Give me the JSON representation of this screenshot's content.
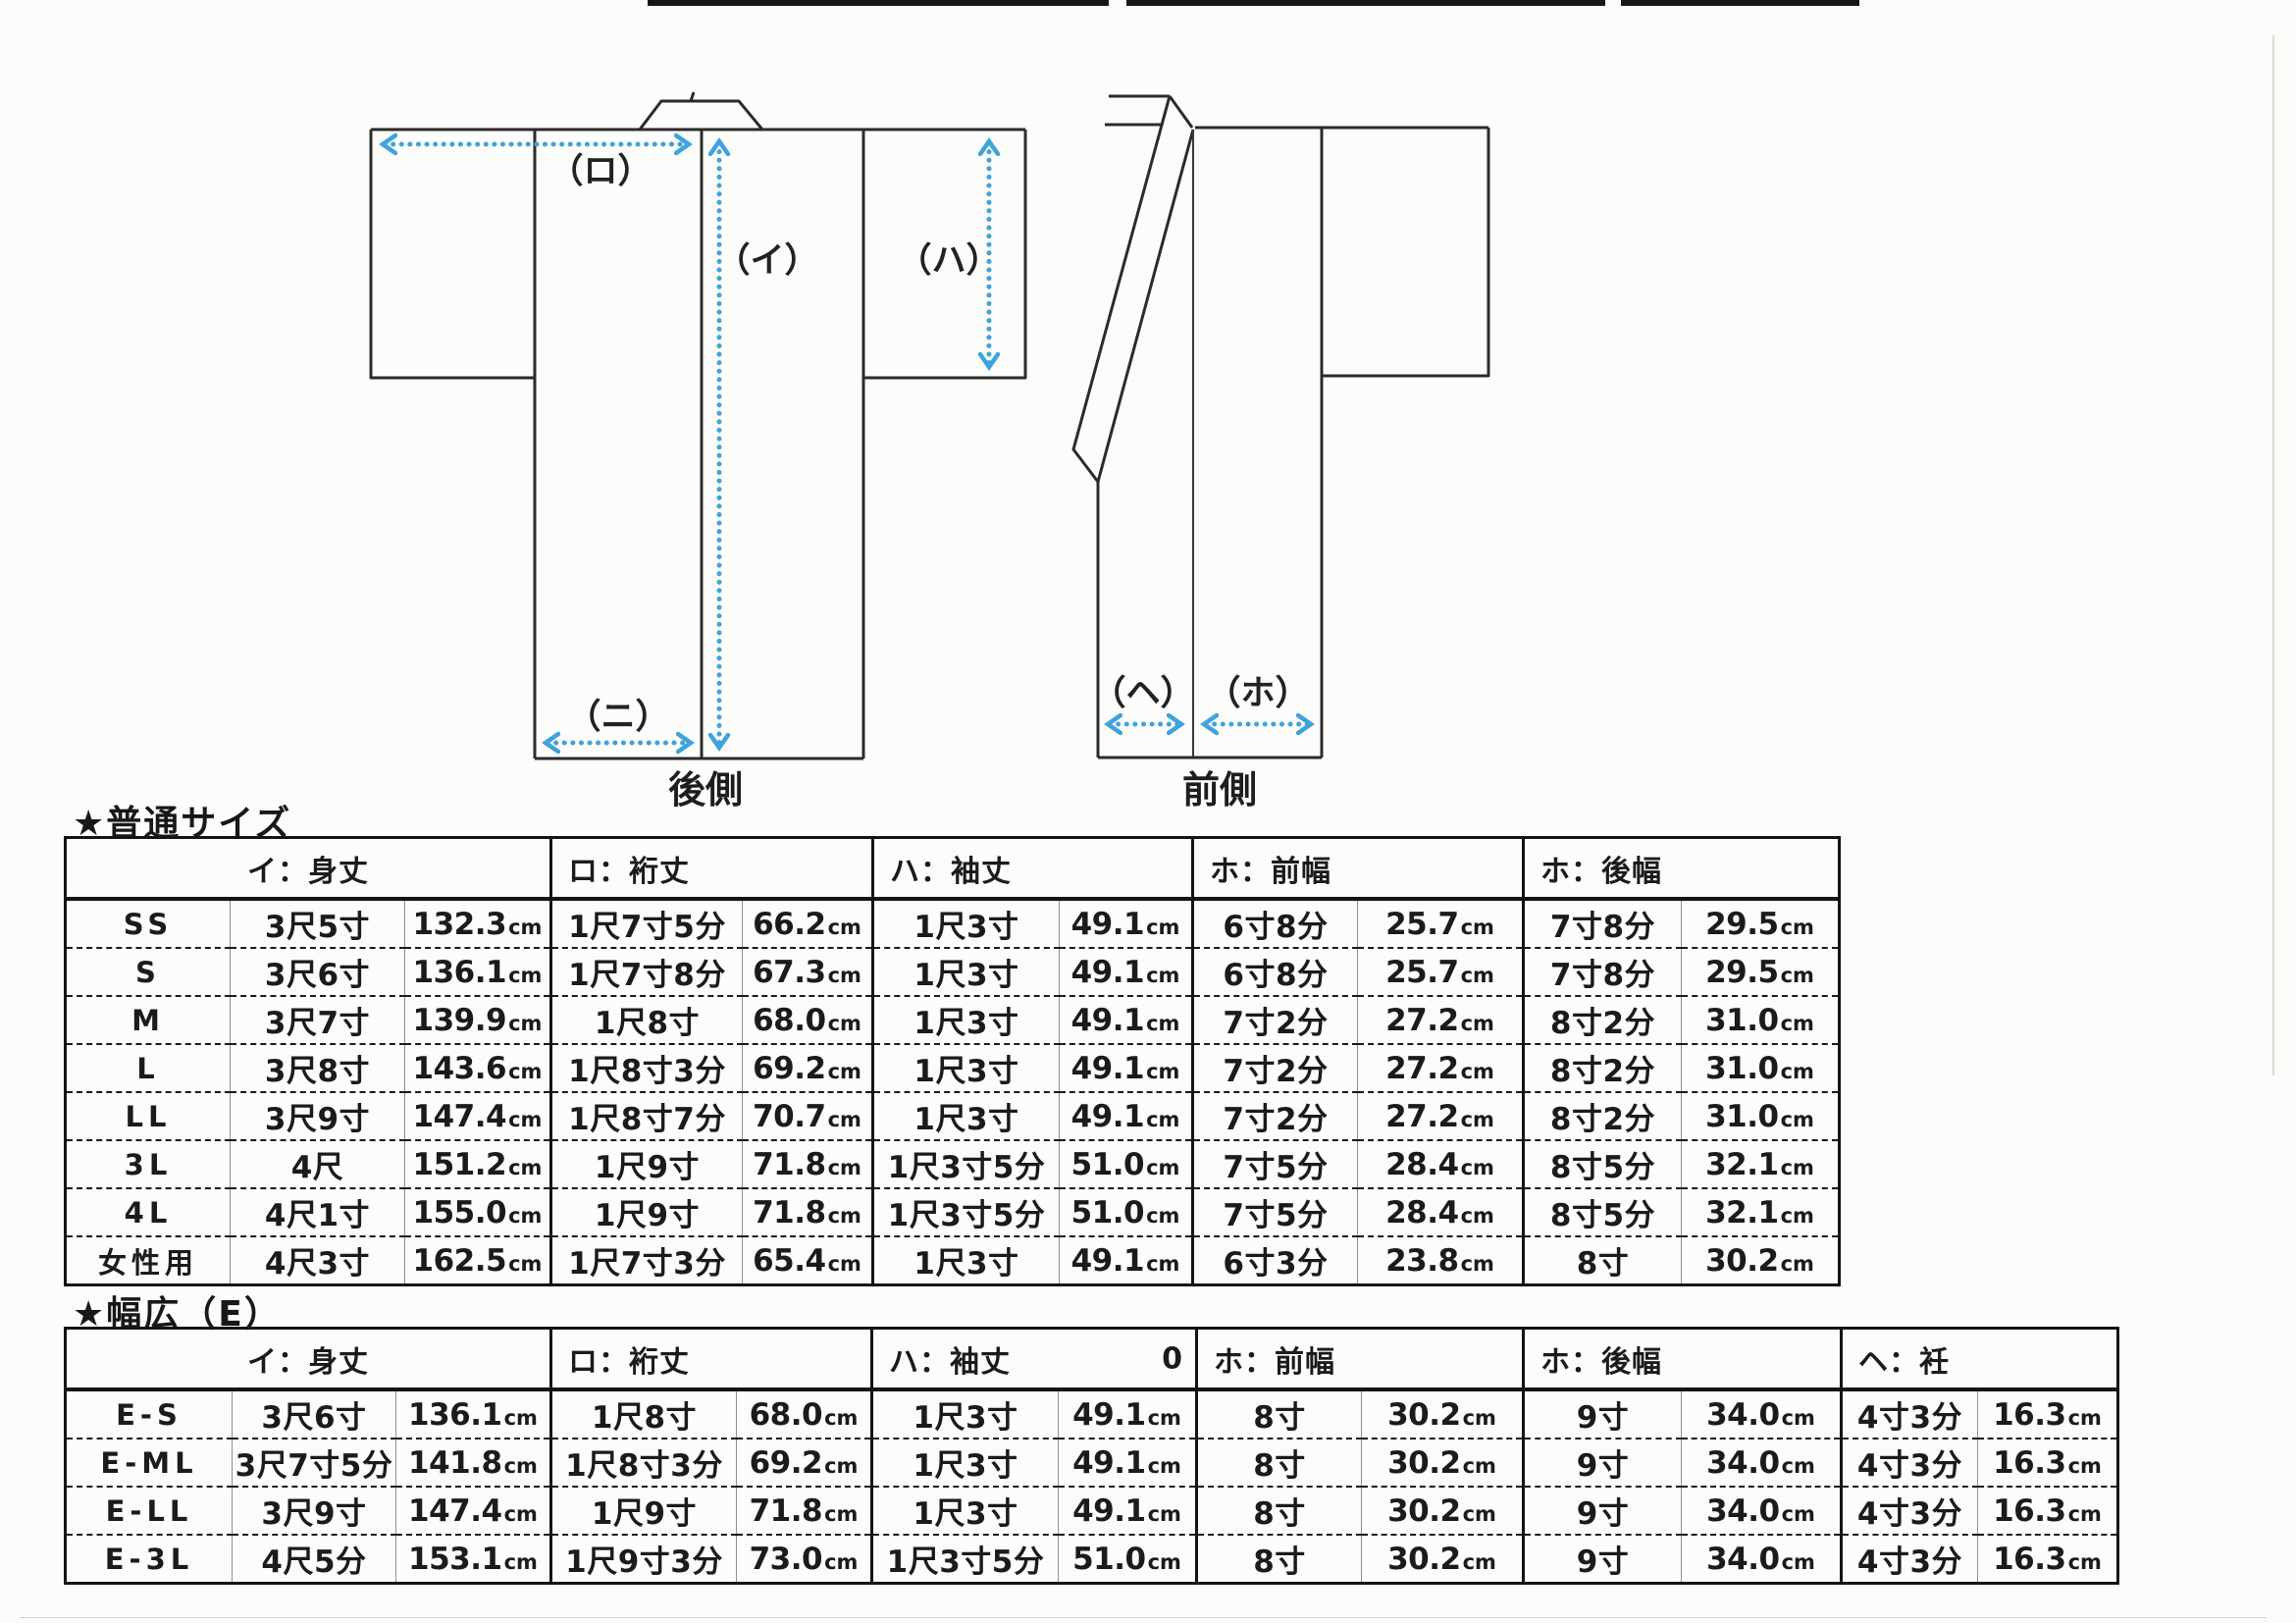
{
  "diagram": {
    "arrow_color": "#3fa3dc",
    "labels": {
      "ro": "（ロ）",
      "i": "（イ）",
      "ha": "（ハ）",
      "ni": "（ニ）",
      "he": "（ヘ）",
      "ho": "（ホ）"
    },
    "back_caption": "後側",
    "front_caption": "前側"
  },
  "sections": {
    "normal": {
      "title": "★普通サイズ",
      "unit": "cm",
      "headers": [
        "イ：身丈",
        "ロ：裄丈",
        "ハ：袖丈",
        "ホ：前幅",
        "ホ：後幅"
      ],
      "fields": [
        "mitake",
        "yuki",
        "sode",
        "maehaba",
        "ushirohaba"
      ],
      "rows": [
        {
          "size": "SS",
          "mitake": "3尺5寸",
          "mitake_cm": "132.3",
          "yuki": "1尺7寸5分",
          "yuki_cm": "66.2",
          "sode": "1尺3寸",
          "sode_cm": "49.1",
          "maehaba": "6寸8分",
          "maehaba_cm": "25.7",
          "ushirohaba": "7寸8分",
          "ushirohaba_cm": "29.5"
        },
        {
          "size": "S",
          "mitake": "3尺6寸",
          "mitake_cm": "136.1",
          "yuki": "1尺7寸8分",
          "yuki_cm": "67.3",
          "sode": "1尺3寸",
          "sode_cm": "49.1",
          "maehaba": "6寸8分",
          "maehaba_cm": "25.7",
          "ushirohaba": "7寸8分",
          "ushirohaba_cm": "29.5"
        },
        {
          "size": "M",
          "mitake": "3尺7寸",
          "mitake_cm": "139.9",
          "yuki": "1尺8寸",
          "yuki_cm": "68.0",
          "sode": "1尺3寸",
          "sode_cm": "49.1",
          "maehaba": "7寸2分",
          "maehaba_cm": "27.2",
          "ushirohaba": "8寸2分",
          "ushirohaba_cm": "31.0"
        },
        {
          "size": "L",
          "mitake": "3尺8寸",
          "mitake_cm": "143.6",
          "yuki": "1尺8寸3分",
          "yuki_cm": "69.2",
          "sode": "1尺3寸",
          "sode_cm": "49.1",
          "maehaba": "7寸2分",
          "maehaba_cm": "27.2",
          "ushirohaba": "8寸2分",
          "ushirohaba_cm": "31.0"
        },
        {
          "size": "LL",
          "mitake": "3尺9寸",
          "mitake_cm": "147.4",
          "yuki": "1尺8寸7分",
          "yuki_cm": "70.7",
          "sode": "1尺3寸",
          "sode_cm": "49.1",
          "maehaba": "7寸2分",
          "maehaba_cm": "27.2",
          "ushirohaba": "8寸2分",
          "ushirohaba_cm": "31.0"
        },
        {
          "size": "3L",
          "mitake": "4尺",
          "mitake_cm": "151.2",
          "yuki": "1尺9寸",
          "yuki_cm": "71.8",
          "sode": "1尺3寸5分",
          "sode_cm": "51.0",
          "maehaba": "7寸5分",
          "maehaba_cm": "28.4",
          "ushirohaba": "8寸5分",
          "ushirohaba_cm": "32.1"
        },
        {
          "size": "4L",
          "mitake": "4尺1寸",
          "mitake_cm": "155.0",
          "yuki": "1尺9寸",
          "yuki_cm": "71.8",
          "sode": "1尺3寸5分",
          "sode_cm": "51.0",
          "maehaba": "7寸5分",
          "maehaba_cm": "28.4",
          "ushirohaba": "8寸5分",
          "ushirohaba_cm": "32.1"
        },
        {
          "size": "女性用",
          "mitake": "4尺3寸",
          "mitake_cm": "162.5",
          "yuki": "1尺7寸3分",
          "yuki_cm": "65.4",
          "sode": "1尺3寸",
          "sode_cm": "49.1",
          "maehaba": "6寸3分",
          "maehaba_cm": "23.8",
          "ushirohaba": "8寸",
          "ushirohaba_cm": "30.2"
        }
      ]
    },
    "wide": {
      "title": "★幅広（E）",
      "unit": "cm",
      "headers": [
        "イ：身丈",
        "ロ：裄丈",
        "ハ：袖丈",
        "ホ：前幅",
        "ホ：後幅",
        "ヘ：衽"
      ],
      "sode_stray": "0",
      "fields": [
        "mitake",
        "yuki",
        "sode",
        "maehaba",
        "ushirohaba",
        "okumi"
      ],
      "rows": [
        {
          "size": "E-S",
          "mitake": "3尺6寸",
          "mitake_cm": "136.1",
          "yuki": "1尺8寸",
          "yuki_cm": "68.0",
          "sode": "1尺3寸",
          "sode_cm": "49.1",
          "maehaba": "8寸",
          "maehaba_cm": "30.2",
          "ushirohaba": "9寸",
          "ushirohaba_cm": "34.0",
          "okumi": "4寸3分",
          "okumi_cm": "16.3"
        },
        {
          "size": "E-ML",
          "mitake": "3尺7寸5分",
          "mitake_cm": "141.8",
          "yuki": "1尺8寸3分",
          "yuki_cm": "69.2",
          "sode": "1尺3寸",
          "sode_cm": "49.1",
          "maehaba": "8寸",
          "maehaba_cm": "30.2",
          "ushirohaba": "9寸",
          "ushirohaba_cm": "34.0",
          "okumi": "4寸3分",
          "okumi_cm": "16.3"
        },
        {
          "size": "E-LL",
          "mitake": "3尺9寸",
          "mitake_cm": "147.4",
          "yuki": "1尺9寸",
          "yuki_cm": "71.8",
          "sode": "1尺3寸",
          "sode_cm": "49.1",
          "maehaba": "8寸",
          "maehaba_cm": "30.2",
          "ushirohaba": "9寸",
          "ushirohaba_cm": "34.0",
          "okumi": "4寸3分",
          "okumi_cm": "16.3"
        },
        {
          "size": "E-3L",
          "mitake": "4尺5分",
          "mitake_cm": "153.1",
          "yuki": "1尺9寸3分",
          "yuki_cm": "73.0",
          "sode": "1尺3寸5分",
          "sode_cm": "51.0",
          "maehaba": "8寸",
          "maehaba_cm": "30.2",
          "ushirohaba": "9寸",
          "ushirohaba_cm": "34.0",
          "okumi": "4寸3分",
          "okumi_cm": "16.3"
        }
      ]
    }
  }
}
